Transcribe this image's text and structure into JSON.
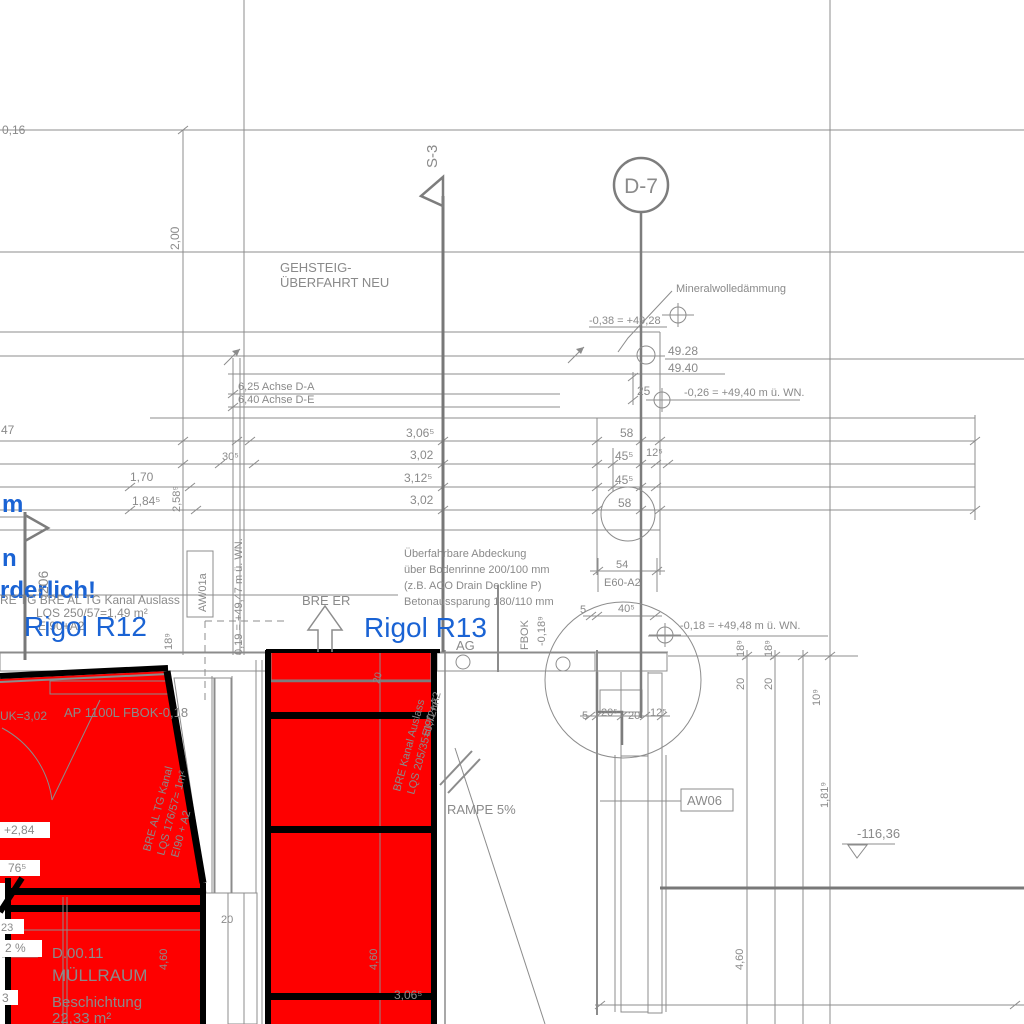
{
  "colors": {
    "red": "#fe0000",
    "blue": "#1a63d4",
    "line_gray": "#8c8c8c",
    "text_gray": "#8a8a8a",
    "black": "#000000"
  },
  "markers": {
    "s3": "S-3",
    "d7": "D-7"
  },
  "axes": {
    "da": "6,25  Achse D-A",
    "de": "6,40  Achse D-E"
  },
  "levels": {
    "l4928eq": "-0,38 = +49,28",
    "l4928": "49.28",
    "l4940": "49.40",
    "l4940eq": "-0,26 = +49,40 m ü. WN.",
    "l4948eq": "-0,18 = +49,48 m ü. WN.",
    "l4947rot": "0,19 = +49,47 m ü. WN.",
    "l284": "+2,84",
    "l11636": "-116,36"
  },
  "dims": {
    "d016": "0,16",
    "d200": "2,00",
    "d47": "47",
    "d170": "1,70",
    "d1845": "1,84⁵",
    "d2589": "2,58⁹",
    "d305": "30⁵",
    "d3065a": "3,06⁵",
    "d302a": "3,02",
    "d3125": "3,12⁵",
    "d302b": "3,02",
    "d58a": "58",
    "d455a": "45⁵",
    "d125a": "12⁵",
    "d455b": "45⁵",
    "d58b": "58",
    "d54": "54",
    "d25": "25",
    "d5a": "5",
    "d405": "40⁵",
    "d5b": "5",
    "d205": "20⁵",
    "d20a": "20",
    "d125b": "12⁵",
    "d189r1": ",18⁹",
    "d20r1": "20",
    "d189r2": ",18⁹",
    "d20r2": "20",
    "d109": "10⁹",
    "d1819": "1,81⁹",
    "d460a": "4,60",
    "d460b": "4,60",
    "d460c": "4,60",
    "d20c": "20",
    "d23": "23",
    "d2pct": "2 %",
    "d3": "3",
    "d765": "76⁵",
    "d189rot": "18⁹",
    "d3065b": "3,06⁵",
    "d20rot": "20",
    "dFbokLvl": "-0,18⁹"
  },
  "notes": {
    "geh1": "GEHSTEIG-",
    "geh2": "ÜBERFAHRT NEU",
    "mineral": "Mineralwolledämmung",
    "ue1": "Überfahrbare Abdeckung",
    "ue2": "über Bodenrinne 200/100 mm",
    "ue3": "(z.B. ACO Drain Deckline P)",
    "ue4": "Betonaussparung 180/110 mm",
    "breer": "BRE ER",
    "ag": "AG",
    "fbok": "FBOK",
    "rampe": "RAMPE 5%",
    "blue_m": "m",
    "blue_n": "n",
    "blue_rest": "rderlich!",
    "v206": ".206",
    "uk": "UK=3,02",
    "ap": "AP 1100L FBOK-0,18"
  },
  "rigol": {
    "r12": "Rigol R12",
    "r13": "Rigol R13",
    "k12a": "RE TG BRE AL TG Kanal Auslass",
    "k12b": "LQS 250/57=1,49 m²",
    "k12c": "EI90+A2",
    "k13a": "BRE Kanal Auslass",
    "k13b": "LQS 205/35=0,72m²",
    "k13c": "EI90 +A2",
    "k11a": "BRE AL TG Kanal",
    "k11b": "LQS 176/57= 1m²",
    "k11c": "EI90 + A2"
  },
  "tags": {
    "e60": "E60-A2",
    "aw06": "AW06",
    "aw01a": "AW/01a"
  },
  "room": {
    "nr": "D.00.11",
    "name": "MÜLLRAUM",
    "coating": "Beschichtung",
    "area": "22,33 m²"
  }
}
